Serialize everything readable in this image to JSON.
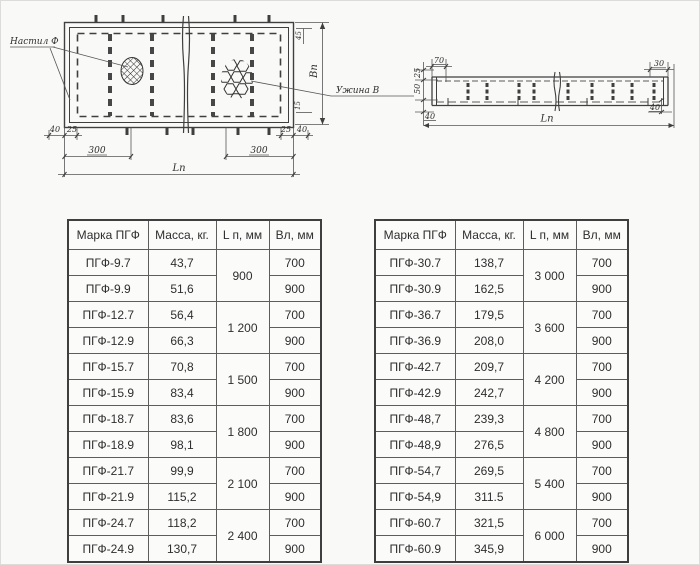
{
  "drawing": {
    "plan": {
      "callout_left": "Настил Ф",
      "callout_right": "Ужина В",
      "dim_40_left": "40",
      "dim_25_left": "25",
      "dim_300_left": "300",
      "dim_300_right": "300",
      "dim_25_right": "25",
      "dim_40_right": "40",
      "dim_45": "45",
      "dim_15": "15",
      "dim_length": "Lп",
      "dim_width": "Вп"
    },
    "elevation": {
      "dim_70": "70",
      "dim_30": "30",
      "dim_25": "25",
      "dim_50": "50",
      "dim_40_left": "40",
      "dim_40_right": "40",
      "dim_length": "Lп"
    }
  },
  "tables": {
    "headers": [
      "Марка ПГФ",
      "Масса, кг.",
      "L п, мм",
      "Вл, мм"
    ],
    "left": {
      "groups": [
        {
          "length": "900",
          "rows": [
            {
              "mark": "ПГФ-9.7",
              "mass": "43,7",
              "width": "700"
            },
            {
              "mark": "ПГФ-9.9",
              "mass": "51,6",
              "width": "900"
            }
          ]
        },
        {
          "length": "1 200",
          "rows": [
            {
              "mark": "ПГФ-12.7",
              "mass": "56,4",
              "width": "700"
            },
            {
              "mark": "ПГФ-12.9",
              "mass": "66,3",
              "width": "900"
            }
          ]
        },
        {
          "length": "1 500",
          "rows": [
            {
              "mark": "ПГФ-15.7",
              "mass": "70,8",
              "width": "700"
            },
            {
              "mark": "ПГФ-15.9",
              "mass": "83,4",
              "width": "900"
            }
          ]
        },
        {
          "length": "1 800",
          "rows": [
            {
              "mark": "ПГФ-18.7",
              "mass": "83,6",
              "width": "700"
            },
            {
              "mark": "ПГФ-18.9",
              "mass": "98,1",
              "width": "900"
            }
          ]
        },
        {
          "length": "2 100",
          "rows": [
            {
              "mark": "ПГФ-21.7",
              "mass": "99,9",
              "width": "700"
            },
            {
              "mark": "ПГФ-21.9",
              "mass": "115,2",
              "width": "900"
            }
          ]
        },
        {
          "length": "2 400",
          "rows": [
            {
              "mark": "ПГФ-24.7",
              "mass": "118,2",
              "width": "700"
            },
            {
              "mark": "ПГФ-24.9",
              "mass": "130,7",
              "width": "900"
            }
          ]
        }
      ]
    },
    "right": {
      "groups": [
        {
          "length": "3 000",
          "rows": [
            {
              "mark": "ПГФ-30.7",
              "mass": "138,7",
              "width": "700"
            },
            {
              "mark": "ПГФ-30.9",
              "mass": "162,5",
              "width": "900"
            }
          ]
        },
        {
          "length": "3 600",
          "rows": [
            {
              "mark": "ПГФ-36.7",
              "mass": "179,5",
              "width": "700"
            },
            {
              "mark": "ПГФ-36.9",
              "mass": "208,0",
              "width": "900"
            }
          ]
        },
        {
          "length": "4 200",
          "rows": [
            {
              "mark": "ПГФ-42.7",
              "mass": "209,7",
              "width": "700"
            },
            {
              "mark": "ПГФ-42.9",
              "mass": "242,7",
              "width": "900"
            }
          ]
        },
        {
          "length": "4 800",
          "rows": [
            {
              "mark": "ПГФ-48,7",
              "mass": "239,3",
              "width": "700"
            },
            {
              "mark": "ПГФ-48,9",
              "mass": "276,5",
              "width": "900"
            }
          ]
        },
        {
          "length": "5 400",
          "rows": [
            {
              "mark": "ПГФ-54,7",
              "mass": "269,5",
              "width": "700"
            },
            {
              "mark": "ПГФ-54,9",
              "mass": "311.5",
              "width": "900"
            }
          ]
        },
        {
          "length": "6 000",
          "rows": [
            {
              "mark": "ПГФ-60.7",
              "mass": "321,5",
              "width": "700"
            },
            {
              "mark": "ПГФ-60.9",
              "mass": "345,9",
              "width": "900"
            }
          ]
        }
      ]
    }
  }
}
